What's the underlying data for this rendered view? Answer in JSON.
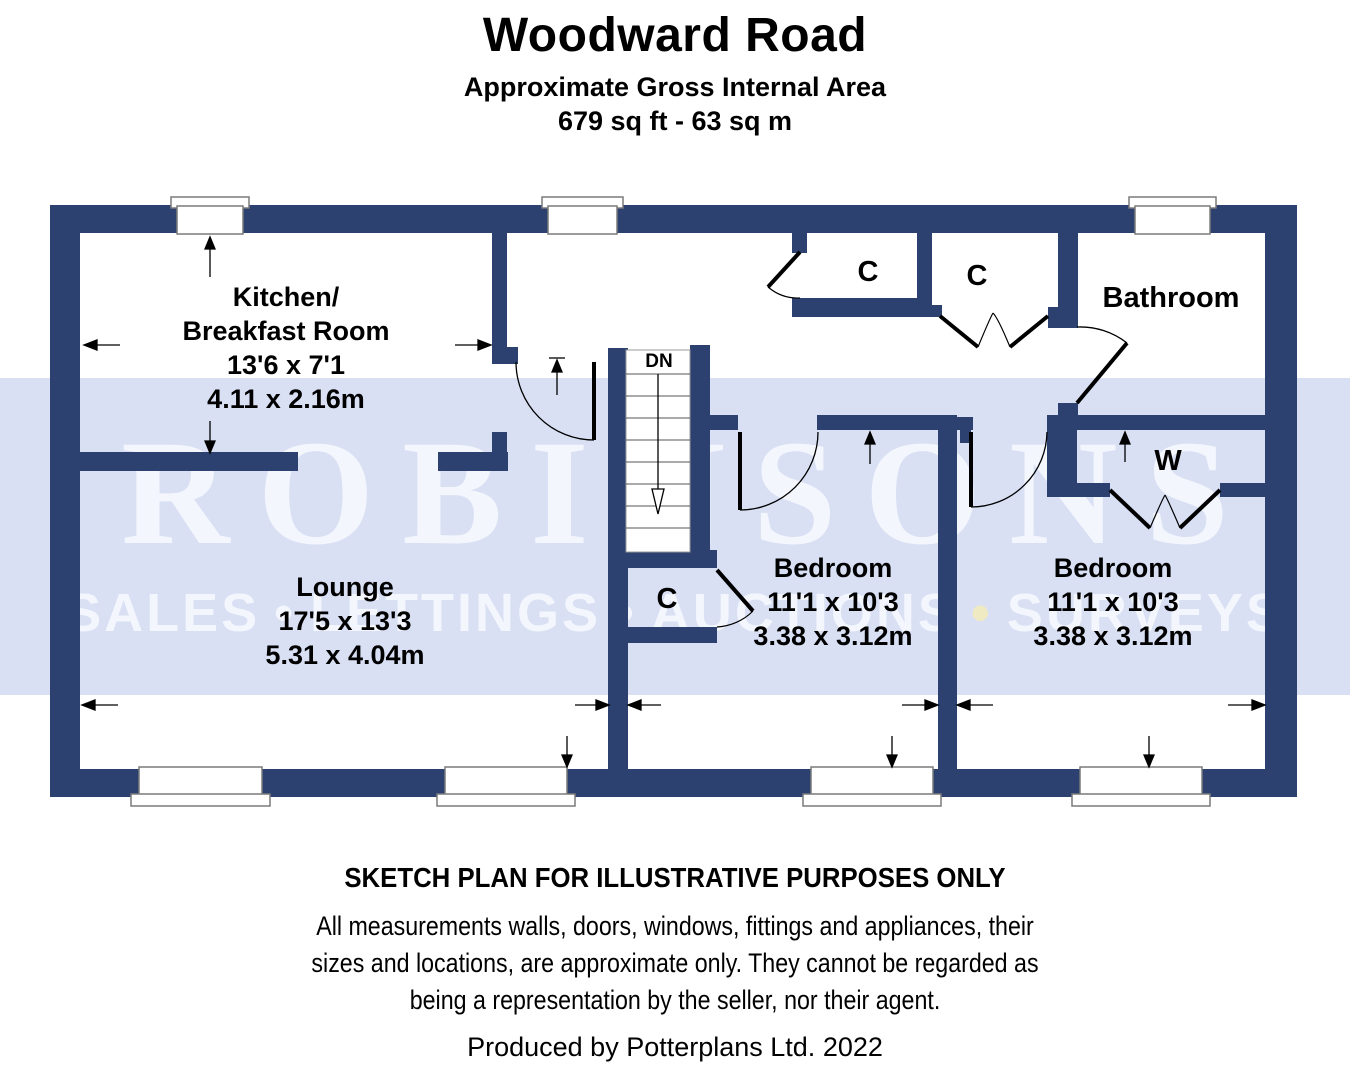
{
  "header": {
    "title": "Woodward Road",
    "subtitle": "Approximate Gross Internal Area",
    "area": "679 sq ft - 63 sq m"
  },
  "watermark": {
    "name": "ROBINSONS",
    "words": [
      "SALES",
      "LETTINGS",
      "AUCTIONS",
      "SURVEYS"
    ],
    "separator": "•",
    "band_color": "#d9e0f4",
    "text_color": "#f3f6fc",
    "accent_bullet_color": "#efeac2"
  },
  "rooms": {
    "kitchen": {
      "name_line1": "Kitchen/",
      "name_line2": "Breakfast Room",
      "imperial": "13'6 x 7'1",
      "metric": "4.11 x 2.16m"
    },
    "lounge": {
      "name": "Lounge",
      "imperial": "17'5 x 13'3",
      "metric": "5.31 x 4.04m"
    },
    "bedroom1": {
      "name": "Bedroom",
      "imperial": "11'1 x 10'3",
      "metric": "3.38 x 3.12m"
    },
    "bedroom2": {
      "name": "Bedroom",
      "imperial": "11'1 x 10'3",
      "metric": "3.38 x 3.12m"
    },
    "bathroom": {
      "name": "Bathroom"
    },
    "closet_hall_left": {
      "label": "C"
    },
    "closet_hall_right": {
      "label": "C"
    },
    "closet_understairs": {
      "label": "C"
    },
    "wardrobe": {
      "label": "W"
    },
    "stairs": {
      "label": "DN"
    }
  },
  "footer": {
    "disclaimer_title": "SKETCH PLAN FOR ILLUSTRATIVE PURPOSES ONLY",
    "disclaimer_lines": [
      "All measurements walls, doors, windows, fittings and appliances, their",
      "sizes and locations, are approximate only. They cannot be regarded as",
      "being a representation by the seller, nor their agent."
    ],
    "produced_by": "Produced by Potterplans Ltd. 2022"
  },
  "colors": {
    "wall": "#2c416f",
    "background": "#ffffff",
    "text": "#000000"
  }
}
